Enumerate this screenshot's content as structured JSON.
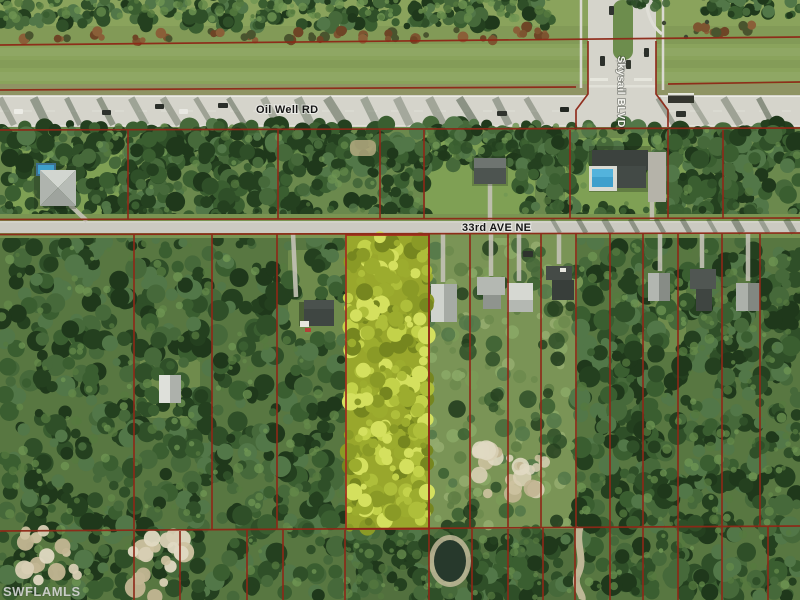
{
  "map": {
    "roads": {
      "oil_well_rd": {
        "label": "Oil Well RD"
      },
      "skysail_blvd": {
        "label": "Skysail BLVD"
      },
      "ave_33_ne": {
        "label": "33rd AVE NE"
      }
    },
    "watermark": {
      "label": "SWFLAMLS"
    },
    "highlighted_parcel": {
      "fill": "#99a72c",
      "outline": "#a3321e"
    },
    "colors": {
      "parcel_line": "#8e2817",
      "road_surface": "#d5d4cb",
      "ave_surface": "#cbcac1",
      "field_green": "#8aa35c",
      "mid_green": "#6b894d",
      "lower_green": "#587741",
      "forest_green": "#3a5a2f",
      "pool_blue": "#3fa0cc",
      "sand": "#cdc2a0",
      "median_green": "#6d8d4d",
      "dirt_strip": "#8f9464"
    }
  }
}
